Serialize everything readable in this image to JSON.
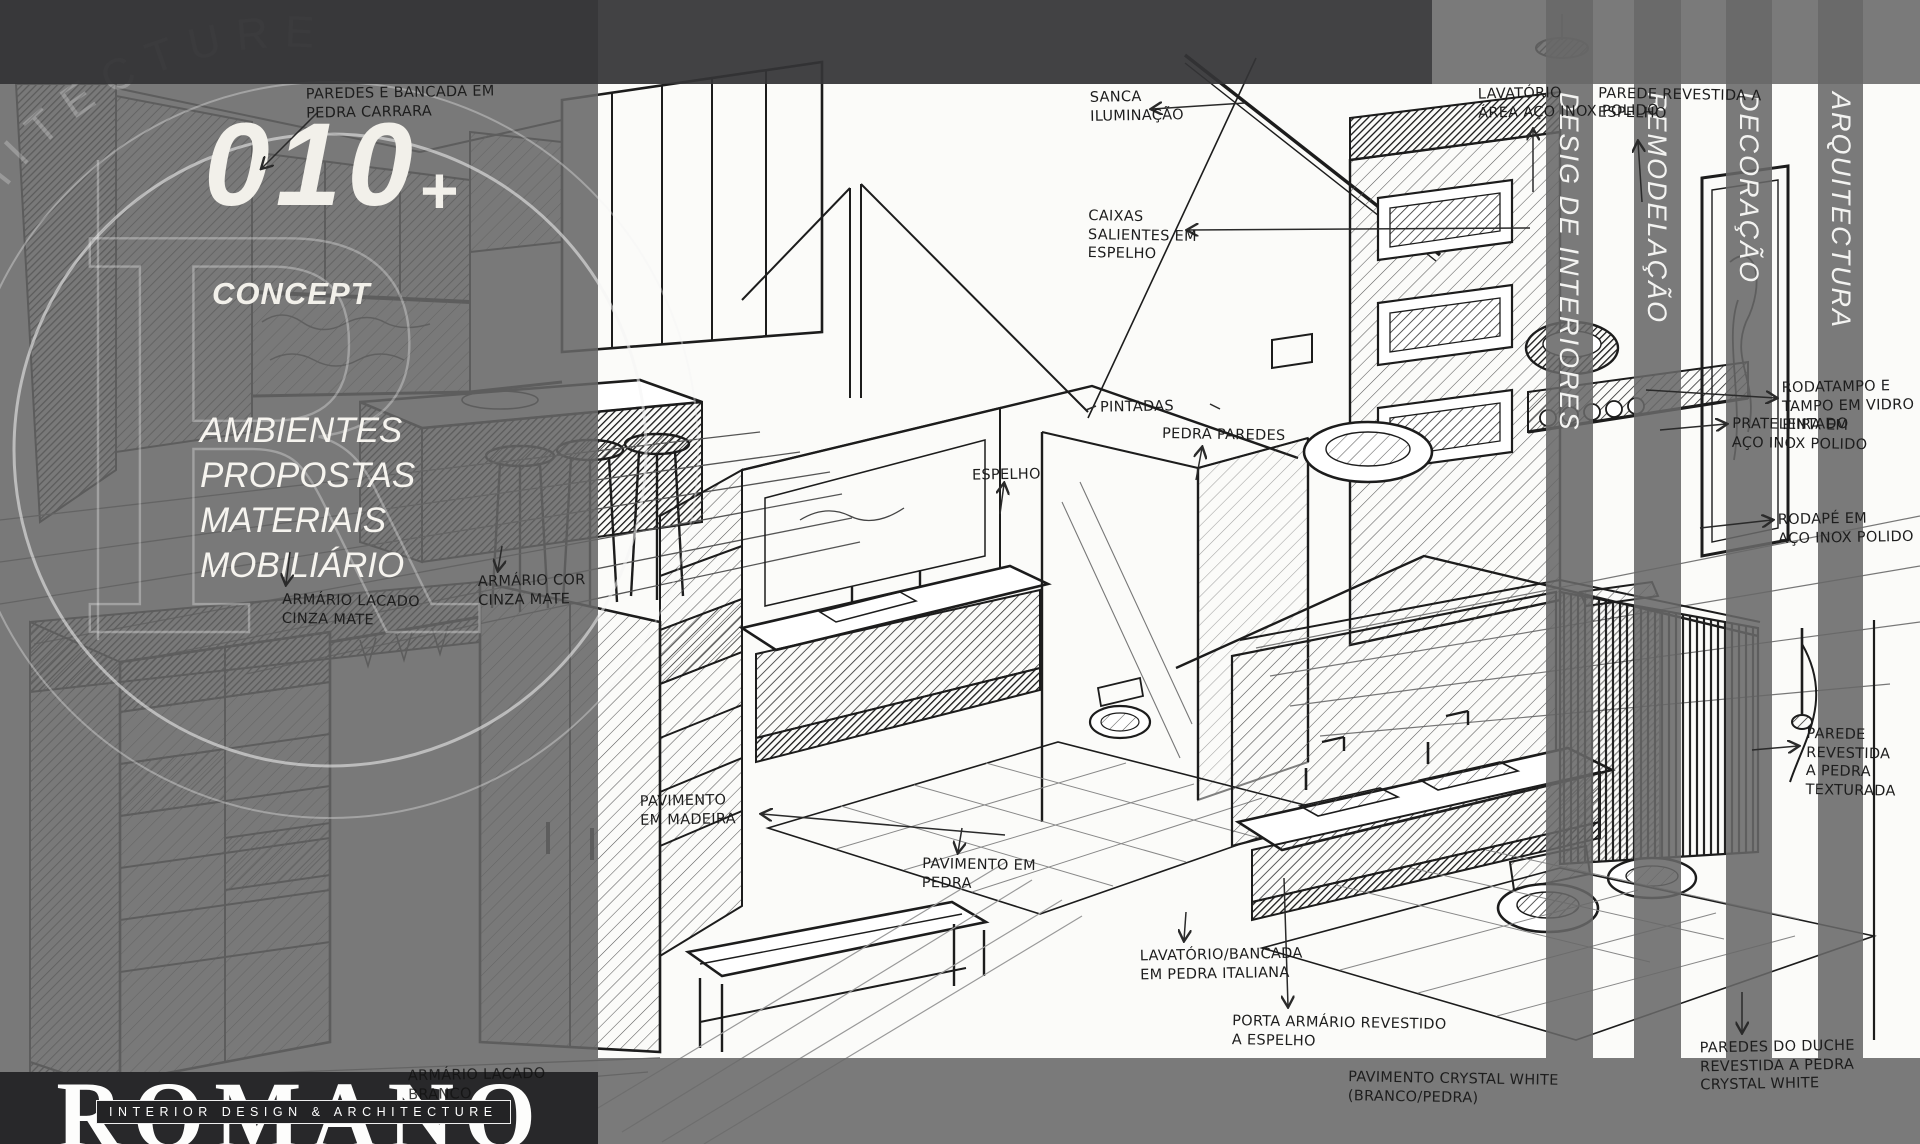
{
  "left_panel": {
    "watermark_arc_text": "ARCHITECTURE",
    "watermark_letter": "R",
    "number": "010",
    "number_plus": "+",
    "concept_label": "CONCEPT",
    "menu": [
      "AMBIENTES",
      "PROPOSTAS",
      "MATERIAIS",
      "MOBILIÁRIO"
    ]
  },
  "brand": {
    "name": "ROMANO",
    "tagline": "INTERIOR DESIGN & ARCHITECTURE"
  },
  "stripes": [
    "DESIG DE INTERIORES",
    "REMODELAÇÃO",
    "DECORAÇÃO",
    "ARQUITECTURA"
  ],
  "annotations": [
    {
      "text": "PAREDES E BANCADA EM\nPEDRA CARRARA"
    },
    {
      "text": "ARMÁRIO LACADO\nCINZA MATE"
    },
    {
      "text": "ARMÁRIO COR\nCINZA MATE"
    },
    {
      "text": "ARMÁRIO LACADO\nBRANCO"
    },
    {
      "text": "SANCA\nILUMINAÇÃO"
    },
    {
      "text": "CAIXAS\nSALIENTES EM\nESPELHO"
    },
    {
      "text": "LAVATÓRIO\nÁREA AÇO INOX POLIDO"
    },
    {
      "text": "PAREDE REVESTIDA A\nESPELHO"
    },
    {
      "text": "RODATAMPO E\nTAMPO EM VIDRO\nPINTADO"
    },
    {
      "text": "PRATELEIRA EM\nAÇO INOX POLIDO"
    },
    {
      "text": "RODAPÉ EM\nAÇO INOX POLIDO"
    },
    {
      "text": "PAREDE REVESTIDA\nA PEDRA\nTEXTURADA"
    },
    {
      "text": "PINTADAS"
    },
    {
      "text": "PEDRA PAREDES"
    },
    {
      "text": "ESPELHO"
    },
    {
      "text": "PAVIMENTO\nEM MADEIRA"
    },
    {
      "text": "PAVIMENTO EM\nPEDRA"
    },
    {
      "text": "LAVATÓRIO/BANCADA\nEM PEDRA ITALIANA"
    },
    {
      "text": "PORTA ARMÁRIO REVESTIDO\nA ESPELHO"
    },
    {
      "text": "PAREDES DO DUCHE\nREVESTIDA A PEDRA\nCRYSTAL WHITE"
    },
    {
      "text": "PAVIMENTO CRYSTAL WHITE\n(BRANCO/PEDRA)"
    }
  ],
  "colors": {
    "overlay_gray": "#666666",
    "top_band": "#343436",
    "brand_bar": "#28282a",
    "ink": "#1d1d1d",
    "canvas": "#fbfbf9",
    "panel_text": "#f2f0ea"
  }
}
